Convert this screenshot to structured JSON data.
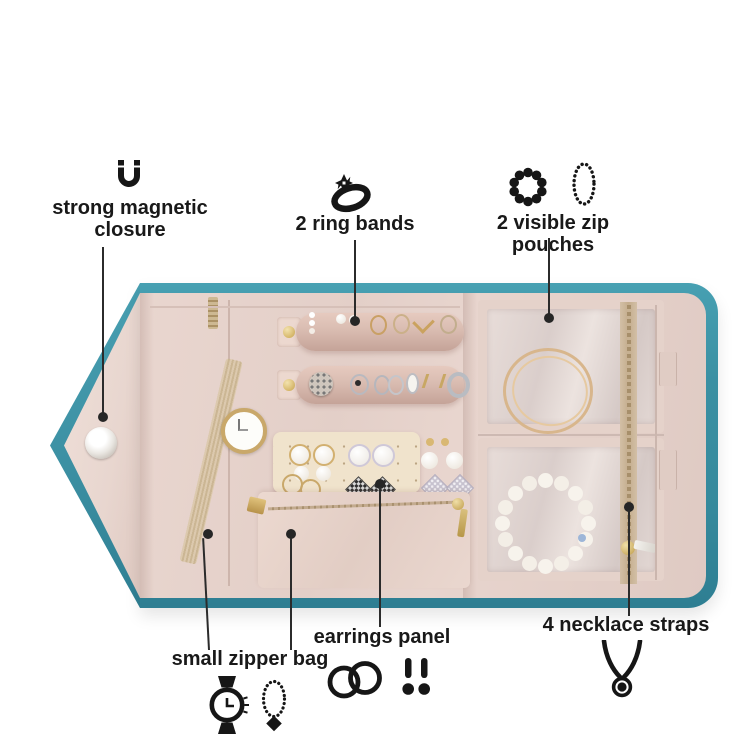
{
  "product": {
    "type": "travel jewelry organizer roll, opened flat"
  },
  "colors": {
    "background": "#ffffff",
    "teal_trim": "#3a90a3",
    "blush_interior": "#e6d2cb",
    "cream_panel": "#f0e3cc",
    "gold_hardware": "#c9a86a",
    "callout_line": "#2b2b2b",
    "label_text": "#191919"
  },
  "callouts": {
    "magnetic_closure": {
      "label": "strong magnetic closure",
      "icon": "magnet-icon"
    },
    "ring_bands": {
      "label": "2 ring bands",
      "icon": "diamond-ring-icon"
    },
    "zip_pouches": {
      "label": "2 visible zip pouches",
      "icons": [
        "beaded-bracelet-icon",
        "beaded-necklace-icon"
      ]
    },
    "necklace_straps": {
      "label": "4 necklace straps",
      "icon": "pendant-necklace-icon"
    },
    "earrings_panel": {
      "label": "earrings panel",
      "icons": [
        "hoop-earrings-icon",
        "stud-earrings-icon"
      ]
    },
    "small_zipper_bag": {
      "label": "small zipper bag",
      "icons": [
        "watch-icon",
        "bead-pendant-icon"
      ]
    }
  }
}
